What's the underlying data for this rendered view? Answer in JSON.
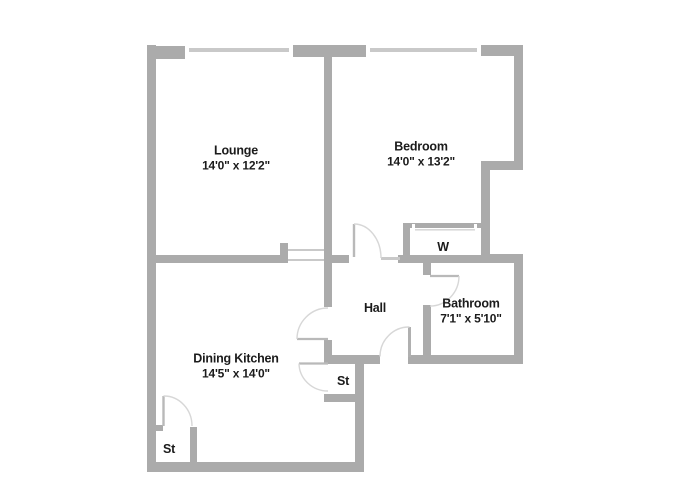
{
  "title": "Floor plan",
  "palette": {
    "wall": "#ababab",
    "window_line": "#c9c9c9",
    "door_leaf": "#b9b9b9",
    "door_arc": "#d7d7d7",
    "text": "#1b1b1b",
    "background": "#ffffff"
  },
  "rooms": [
    {
      "id": "lounge",
      "name": "Lounge",
      "dims": "14'0\" x 12'2\""
    },
    {
      "id": "bedroom",
      "name": "Bedroom",
      "dims": "14'0\" x 13'2\""
    },
    {
      "id": "hall",
      "name": "Hall",
      "dims": ""
    },
    {
      "id": "bathroom",
      "name": "Bathroom",
      "dims": "7'1\" x 5'10\""
    },
    {
      "id": "dining-kitchen",
      "name": "Dining Kitchen",
      "dims": "14'5\" x 14'0\""
    },
    {
      "id": "wardrobe",
      "name": "W",
      "dims": ""
    },
    {
      "id": "store-hall",
      "name": "St",
      "dims": ""
    },
    {
      "id": "store-kitchen",
      "name": "St",
      "dims": ""
    }
  ]
}
